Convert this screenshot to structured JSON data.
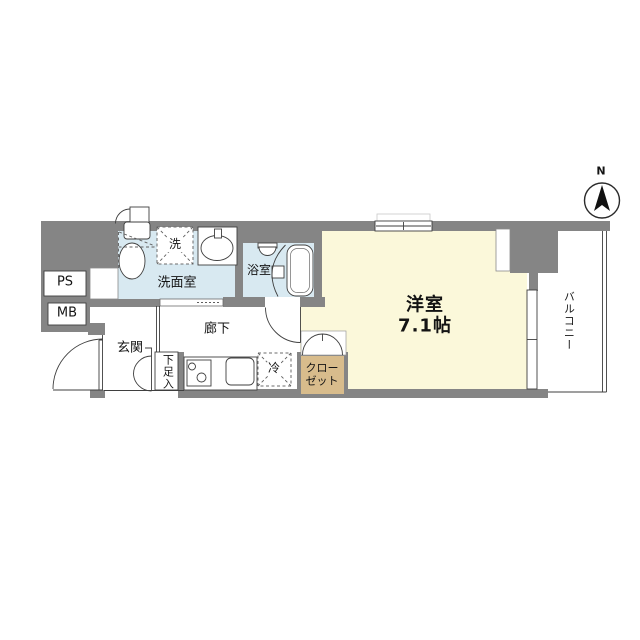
{
  "labels": {
    "ps": "PS",
    "mb": "MB",
    "washroom": "洗面室",
    "washer": "洗",
    "bathroom": "浴室",
    "entrance": "玄関",
    "shoe_cabinet": "下足入",
    "corridor": "廊下",
    "refrigerator": "冷",
    "closet_line1": "クロー",
    "closet_line2": "ゼット",
    "main_room": "洋室",
    "main_room_size": "7.1帖",
    "balcony": "バルコニー",
    "compass_north": "N"
  },
  "colors": {
    "wall": "#858585",
    "water_area": "#d8e9f1",
    "room_cream": "#fbf8da",
    "closet_tan": "#d8bc8c",
    "line": "#3f3f3f"
  }
}
